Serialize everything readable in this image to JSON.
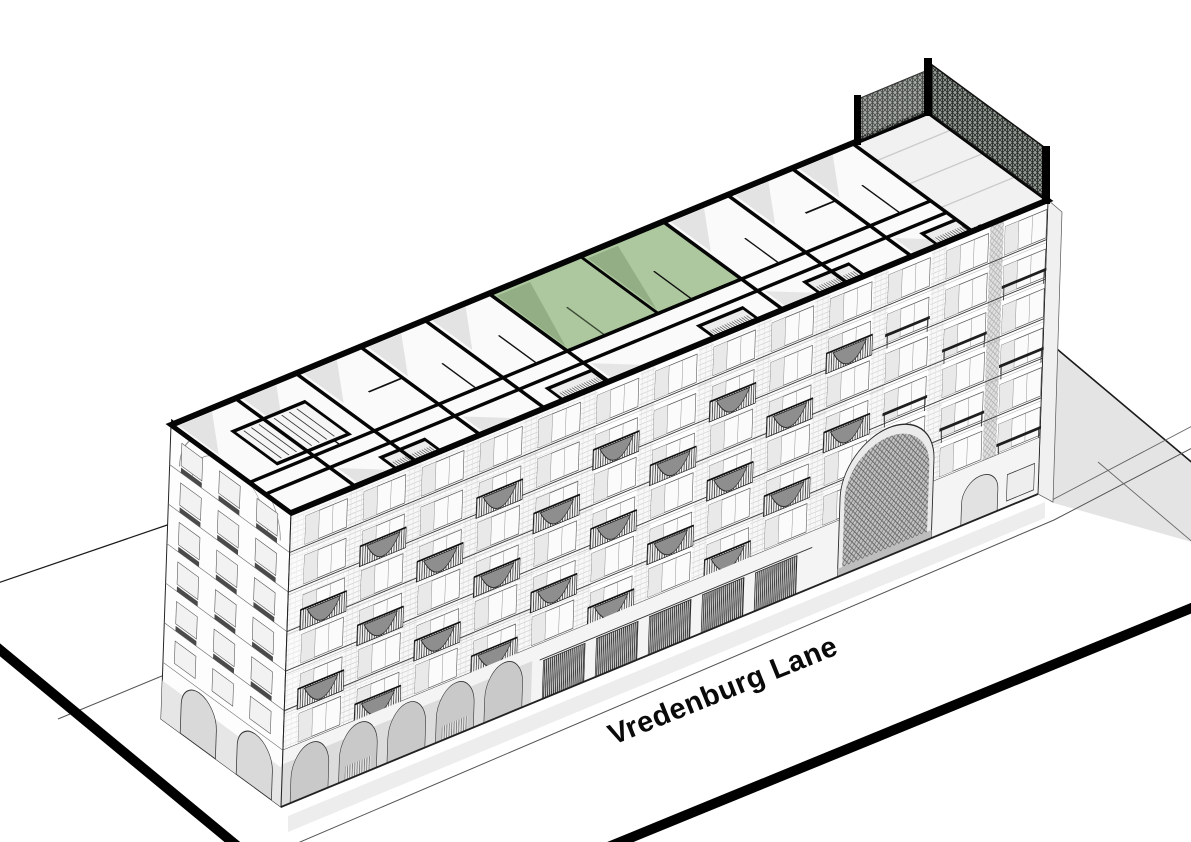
{
  "scene": {
    "street_label": "Vredenburg Lane",
    "view": "axonometric cutaway of an apartment block with the top floor opened as a plan"
  },
  "colors": {
    "background": "#ffffff",
    "linework": "#1a1a1a",
    "cut_wall": "#050505",
    "unit_highlight": "#adc89f",
    "unit_highlight_shade": "#90ab82",
    "ground_shadow": "#e4e4e4",
    "facade_shadow": "#ededed",
    "arcade_interior": "#d9d9d9",
    "street_edge": "#000000"
  },
  "building": {
    "storeys_visible": 7,
    "cutaway_level": "top floor shown as plan",
    "highlighted_unit_rooms": 2,
    "ground_floor": "arcade arches, shop grilles and a large arched gateway",
    "roof_right_end": "terrace with planted trellis screens"
  }
}
